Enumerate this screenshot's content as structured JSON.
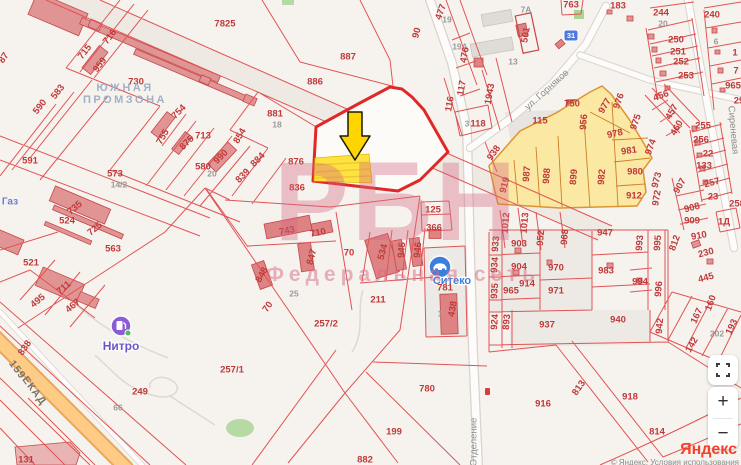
{
  "watermark": {
    "title": "РБН",
    "subtitle": "Федеральная сеть"
  },
  "attribution": {
    "logo": "Яндекс",
    "copyright": "© Яндекс, Условия использования"
  },
  "controls": {
    "zoom_in": "+",
    "zoom_out": "−"
  },
  "map": {
    "road_badge": {
      "text": "31"
    },
    "pois": [
      {
        "label": "Нитро",
        "type": "fuel-station"
      },
      {
        "label": "Ситеко",
        "type": "car-service"
      }
    ],
    "area_labels": [
      {
        "t": "ЮЖНАЯ",
        "x": 125,
        "y": 88
      },
      {
        "t": "ПРОМЗОНА",
        "x": 125,
        "y": 100
      },
      {
        "t": "Газ",
        "x": 10,
        "y": 202,
        "cls": "lbl-gaz"
      }
    ],
    "streets": [
      {
        "t": "ул. Горняков",
        "x": 547,
        "y": 90,
        "r": -42
      },
      {
        "t": "Отделение",
        "x": 474,
        "y": 442,
        "r": -90
      },
      {
        "t": "Сиреневая",
        "x": 733,
        "y": 130,
        "r": 85
      },
      {
        "t": "ЕКАД",
        "x": 34,
        "y": 391,
        "r": 53,
        "cls": "lbl-road"
      },
      {
        "t": "159",
        "x": 17,
        "y": 370,
        "r": 53,
        "cls": "lbl-road"
      }
    ],
    "parcels": [
      {
        "t": "7825",
        "x": 225,
        "y": 24
      },
      {
        "t": "716",
        "x": 110,
        "y": 37,
        "r": -52
      },
      {
        "t": "715",
        "x": 85,
        "y": 52,
        "r": -52
      },
      {
        "t": "959",
        "x": 100,
        "y": 65,
        "r": -52
      },
      {
        "t": "730",
        "x": 136,
        "y": 82
      },
      {
        "t": "583",
        "x": 58,
        "y": 92,
        "r": -52
      },
      {
        "t": "590",
        "x": 40,
        "y": 107,
        "r": -52
      },
      {
        "t": "87",
        "x": 4,
        "y": 58,
        "r": -55
      },
      {
        "t": "754",
        "x": 179,
        "y": 112,
        "r": -45
      },
      {
        "t": "755",
        "x": 163,
        "y": 137,
        "r": -60
      },
      {
        "t": "875",
        "x": 187,
        "y": 143,
        "r": -45
      },
      {
        "t": "713",
        "x": 203,
        "y": 136
      },
      {
        "t": "990",
        "x": 221,
        "y": 157,
        "r": -45
      },
      {
        "t": "580",
        "x": 203,
        "y": 167
      },
      {
        "t": "20",
        "x": 212,
        "y": 174,
        "g": 1
      },
      {
        "t": "854",
        "x": 240,
        "y": 136,
        "r": -60
      },
      {
        "t": "839",
        "x": 243,
        "y": 176,
        "r": -45
      },
      {
        "t": "884",
        "x": 258,
        "y": 160,
        "r": -45
      },
      {
        "t": "876",
        "x": 296,
        "y": 162
      },
      {
        "t": "836",
        "x": 297,
        "y": 188
      },
      {
        "t": "591",
        "x": 30,
        "y": 161
      },
      {
        "t": "573",
        "x": 115,
        "y": 174
      },
      {
        "t": "14/2",
        "x": 119,
        "y": 185,
        "g": 1
      },
      {
        "t": "524",
        "x": 67,
        "y": 221
      },
      {
        "t": "735",
        "x": 75,
        "y": 208,
        "r": -40
      },
      {
        "t": "725",
        "x": 95,
        "y": 229,
        "r": -40
      },
      {
        "t": "521",
        "x": 31,
        "y": 263
      },
      {
        "t": "563",
        "x": 113,
        "y": 249
      },
      {
        "t": "495",
        "x": 38,
        "y": 301,
        "r": -40
      },
      {
        "t": "711",
        "x": 64,
        "y": 288,
        "r": -40
      },
      {
        "t": "467",
        "x": 73,
        "y": 306,
        "r": -40
      },
      {
        "t": "838",
        "x": 25,
        "y": 348,
        "r": -55
      },
      {
        "t": "131",
        "x": 26,
        "y": 460
      },
      {
        "t": "887",
        "x": 348,
        "y": 57
      },
      {
        "t": "886",
        "x": 315,
        "y": 82
      },
      {
        "t": "881",
        "x": 275,
        "y": 114
      },
      {
        "t": "18",
        "x": 277,
        "y": 125,
        "g": 1
      },
      {
        "t": "90",
        "x": 417,
        "y": 33,
        "r": -75
      },
      {
        "t": "477",
        "x": 441,
        "y": 12,
        "r": -70
      },
      {
        "t": "19",
        "x": 447,
        "y": 20,
        "g": 1
      },
      {
        "t": "19А",
        "x": 460,
        "y": 47,
        "g": 1
      },
      {
        "t": "476",
        "x": 465,
        "y": 55,
        "r": -80
      },
      {
        "t": "501",
        "x": 526,
        "y": 35,
        "r": -80
      },
      {
        "t": "7А",
        "x": 526,
        "y": 10,
        "g": 1
      },
      {
        "t": "13",
        "x": 513,
        "y": 62,
        "g": 1
      },
      {
        "t": "763",
        "x": 571,
        "y": 5
      },
      {
        "t": "183",
        "x": 618,
        "y": 6
      },
      {
        "t": "117",
        "x": 462,
        "y": 88,
        "r": -80
      },
      {
        "t": "116",
        "x": 450,
        "y": 104,
        "r": -80
      },
      {
        "t": "1943",
        "x": 490,
        "y": 94,
        "r": -80
      },
      {
        "t": "118",
        "x": 478,
        "y": 124
      },
      {
        "t": "3",
        "x": 467,
        "y": 124,
        "g": 1
      },
      {
        "t": "244",
        "x": 661,
        "y": 13
      },
      {
        "t": "20",
        "x": 663,
        "y": 24,
        "g": 1
      },
      {
        "t": "250",
        "x": 676,
        "y": 40
      },
      {
        "t": "251",
        "x": 678,
        "y": 52
      },
      {
        "t": "252",
        "x": 681,
        "y": 62
      },
      {
        "t": "253",
        "x": 686,
        "y": 76
      },
      {
        "t": "240",
        "x": 712,
        "y": 15
      },
      {
        "t": "6",
        "x": 716,
        "y": 42,
        "g": 1
      },
      {
        "t": "1",
        "x": 735,
        "y": 53
      },
      {
        "t": "7",
        "x": 736,
        "y": 71
      },
      {
        "t": "965",
        "x": 733,
        "y": 86
      },
      {
        "t": "29",
        "x": 739,
        "y": 101
      },
      {
        "t": "456",
        "x": 661,
        "y": 96,
        "r": -20
      },
      {
        "t": "457",
        "x": 672,
        "y": 112,
        "r": -60
      },
      {
        "t": "460",
        "x": 677,
        "y": 128,
        "r": -60
      },
      {
        "t": "255",
        "x": 703,
        "y": 126
      },
      {
        "t": "256",
        "x": 701,
        "y": 140
      },
      {
        "t": "22",
        "x": 708,
        "y": 154
      },
      {
        "t": "133",
        "x": 704,
        "y": 166
      },
      {
        "t": "257",
        "x": 712,
        "y": 183,
        "r": -15
      },
      {
        "t": "23",
        "x": 713,
        "y": 197
      },
      {
        "t": "907",
        "x": 680,
        "y": 186,
        "r": -60
      },
      {
        "t": "908",
        "x": 692,
        "y": 208,
        "r": -15
      },
      {
        "t": "909",
        "x": 692,
        "y": 221
      },
      {
        "t": "1Д",
        "x": 724,
        "y": 222
      },
      {
        "t": "258",
        "x": 737,
        "y": 204
      },
      {
        "t": "750",
        "x": 572,
        "y": 104
      },
      {
        "t": "115",
        "x": 540,
        "y": 121
      },
      {
        "t": "956",
        "x": 584,
        "y": 122,
        "r": -85
      },
      {
        "t": "977",
        "x": 605,
        "y": 106,
        "r": -60
      },
      {
        "t": "976",
        "x": 619,
        "y": 101,
        "r": -70
      },
      {
        "t": "975",
        "x": 636,
        "y": 122,
        "r": -70
      },
      {
        "t": "974",
        "x": 651,
        "y": 147,
        "r": -70
      },
      {
        "t": "978",
        "x": 615,
        "y": 134,
        "r": -12
      },
      {
        "t": "981",
        "x": 629,
        "y": 151,
        "r": -8
      },
      {
        "t": "980",
        "x": 635,
        "y": 172
      },
      {
        "t": "912",
        "x": 634,
        "y": 196
      },
      {
        "t": "982",
        "x": 602,
        "y": 177,
        "r": -85
      },
      {
        "t": "899",
        "x": 574,
        "y": 177,
        "r": -85
      },
      {
        "t": "988",
        "x": 547,
        "y": 176,
        "r": -85
      },
      {
        "t": "987",
        "x": 527,
        "y": 174,
        "r": -85
      },
      {
        "t": "919",
        "x": 505,
        "y": 185,
        "r": -75
      },
      {
        "t": "938",
        "x": 494,
        "y": 153,
        "r": -55
      },
      {
        "t": "973",
        "x": 657,
        "y": 180,
        "r": -75
      },
      {
        "t": "972",
        "x": 657,
        "y": 198,
        "r": -80
      },
      {
        "t": "1012",
        "x": 506,
        "y": 223,
        "r": -85
      },
      {
        "t": "1013",
        "x": 525,
        "y": 223,
        "r": -85
      },
      {
        "t": "952",
        "x": 541,
        "y": 238,
        "r": -85
      },
      {
        "t": "968",
        "x": 565,
        "y": 237,
        "r": -85
      },
      {
        "t": "947",
        "x": 605,
        "y": 233
      },
      {
        "t": "993",
        "x": 640,
        "y": 243,
        "r": -85
      },
      {
        "t": "995",
        "x": 658,
        "y": 243,
        "r": -85
      },
      {
        "t": "812",
        "x": 675,
        "y": 243,
        "r": -70
      },
      {
        "t": "910",
        "x": 699,
        "y": 236,
        "r": -10
      },
      {
        "t": "230",
        "x": 706,
        "y": 253,
        "r": -15
      },
      {
        "t": "445",
        "x": 706,
        "y": 278,
        "r": -15
      },
      {
        "t": "167",
        "x": 697,
        "y": 316,
        "r": -65
      },
      {
        "t": "160",
        "x": 711,
        "y": 303,
        "r": -70
      },
      {
        "t": "142",
        "x": 692,
        "y": 345,
        "r": -60
      },
      {
        "t": "193",
        "x": 732,
        "y": 327,
        "r": -65
      },
      {
        "t": "202",
        "x": 717,
        "y": 334,
        "g": 1
      },
      {
        "t": "903",
        "x": 519,
        "y": 244
      },
      {
        "t": "933",
        "x": 496,
        "y": 244,
        "r": -85
      },
      {
        "t": "904",
        "x": 519,
        "y": 267
      },
      {
        "t": "934",
        "x": 495,
        "y": 265,
        "r": -85
      },
      {
        "t": "970",
        "x": 556,
        "y": 268
      },
      {
        "t": "914",
        "x": 527,
        "y": 284
      },
      {
        "t": "965",
        "x": 511,
        "y": 291
      },
      {
        "t": "935",
        "x": 495,
        "y": 291,
        "r": -85
      },
      {
        "t": "971",
        "x": 556,
        "y": 291
      },
      {
        "t": "983",
        "x": 606,
        "y": 271
      },
      {
        "t": "994",
        "x": 640,
        "y": 282
      },
      {
        "t": "996",
        "x": 659,
        "y": 289,
        "r": -85
      },
      {
        "t": "924",
        "x": 495,
        "y": 322,
        "r": -85
      },
      {
        "t": "893",
        "x": 507,
        "y": 322,
        "r": -85
      },
      {
        "t": "937",
        "x": 547,
        "y": 325
      },
      {
        "t": "940",
        "x": 618,
        "y": 320
      },
      {
        "t": "942",
        "x": 660,
        "y": 326,
        "r": -85
      },
      {
        "t": "813",
        "x": 579,
        "y": 388,
        "r": -55
      },
      {
        "t": "918",
        "x": 630,
        "y": 397
      },
      {
        "t": "916",
        "x": 543,
        "y": 404
      },
      {
        "t": "814",
        "x": 657,
        "y": 432
      },
      {
        "t": "780",
        "x": 427,
        "y": 389
      },
      {
        "t": "199",
        "x": 394,
        "y": 432
      },
      {
        "t": "882",
        "x": 365,
        "y": 460
      },
      {
        "t": "249",
        "x": 140,
        "y": 392
      },
      {
        "t": "66",
        "x": 118,
        "y": 408,
        "g": 1
      },
      {
        "t": "257/1",
        "x": 232,
        "y": 370
      },
      {
        "t": "257/2",
        "x": 326,
        "y": 324
      },
      {
        "t": "211",
        "x": 378,
        "y": 300
      },
      {
        "t": "25",
        "x": 294,
        "y": 294,
        "g": 1
      },
      {
        "t": "70",
        "x": 268,
        "y": 307,
        "r": -55
      },
      {
        "t": "743",
        "x": 287,
        "y": 231,
        "r": -10
      },
      {
        "t": "710",
        "x": 318,
        "y": 233,
        "r": -10
      },
      {
        "t": "70",
        "x": 349,
        "y": 253
      },
      {
        "t": "847",
        "x": 312,
        "y": 257,
        "r": -75
      },
      {
        "t": "848",
        "x": 262,
        "y": 275,
        "r": -60
      },
      {
        "t": "534",
        "x": 383,
        "y": 252,
        "r": -75
      },
      {
        "t": "945",
        "x": 402,
        "y": 250,
        "r": -85
      },
      {
        "t": "946",
        "x": 418,
        "y": 250,
        "r": -85
      },
      {
        "t": "125",
        "x": 433,
        "y": 210
      },
      {
        "t": "366",
        "x": 434,
        "y": 228
      },
      {
        "t": "781",
        "x": 445,
        "y": 288
      },
      {
        "t": "438",
        "x": 453,
        "y": 309,
        "r": -80
      },
      {
        "t": "1",
        "x": 440,
        "y": 314,
        "g": 1
      }
    ]
  }
}
